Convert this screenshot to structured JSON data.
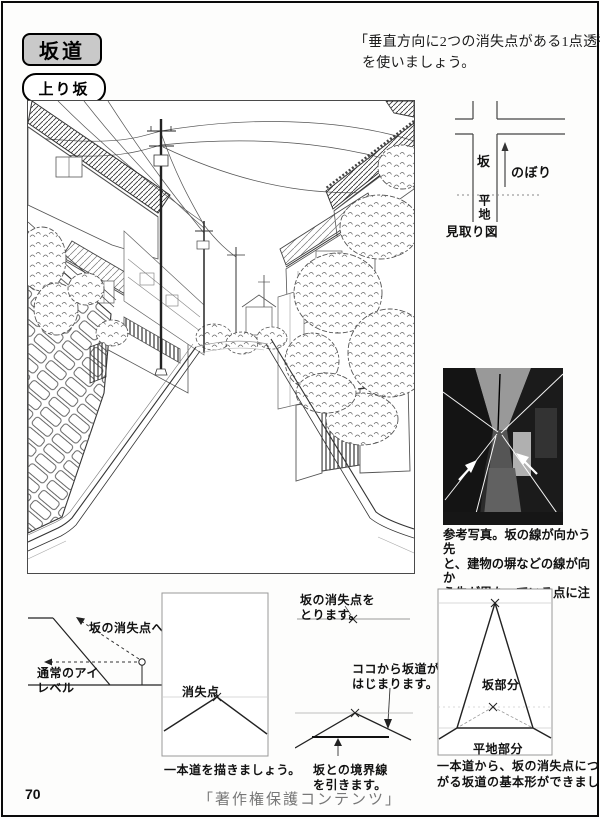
{
  "theme": {
    "title_box_bg": "#c9c9c9",
    "ink": "#1a1a1a",
    "footer_gray": "#777777"
  },
  "header": {
    "title": "坂道",
    "note_line1": "「垂直方向に2つの消失点がある1点透視」",
    "note_line2": "を使いましょう。",
    "section": "上り坂"
  },
  "map": {
    "slope": "坂",
    "nobori": "のぼり",
    "flat": "平地",
    "caption": "見取り図"
  },
  "photo": {
    "caption1": "参考写真。坂の線が向かう先",
    "caption2": "と、建物の塀などの線が向か",
    "caption3": "う先が異なっている点に注目",
    "caption4": "しましょう。"
  },
  "d1": {
    "to_vp": "坂の消失点へ",
    "eye1": "通常のアイ",
    "eye2": "レベル"
  },
  "d2": {
    "vp": "消失点",
    "caption": "一本道を描きましょう。"
  },
  "d3": {
    "take1": "坂の消失点を",
    "take2": "とります。",
    "here1": "ココから坂道が",
    "here2": "はじまります。",
    "bound1": "坂との境界線",
    "bound2": "を引きます。"
  },
  "d4": {
    "slope_part": "坂部分",
    "flat_part": "平地部分",
    "caption1": "一本道から、坂の消失点につな",
    "caption2": "がる坂道の基本形ができました。"
  },
  "page": {
    "page_number": "70",
    "copyright": "「著作権保護コンテンツ」"
  }
}
